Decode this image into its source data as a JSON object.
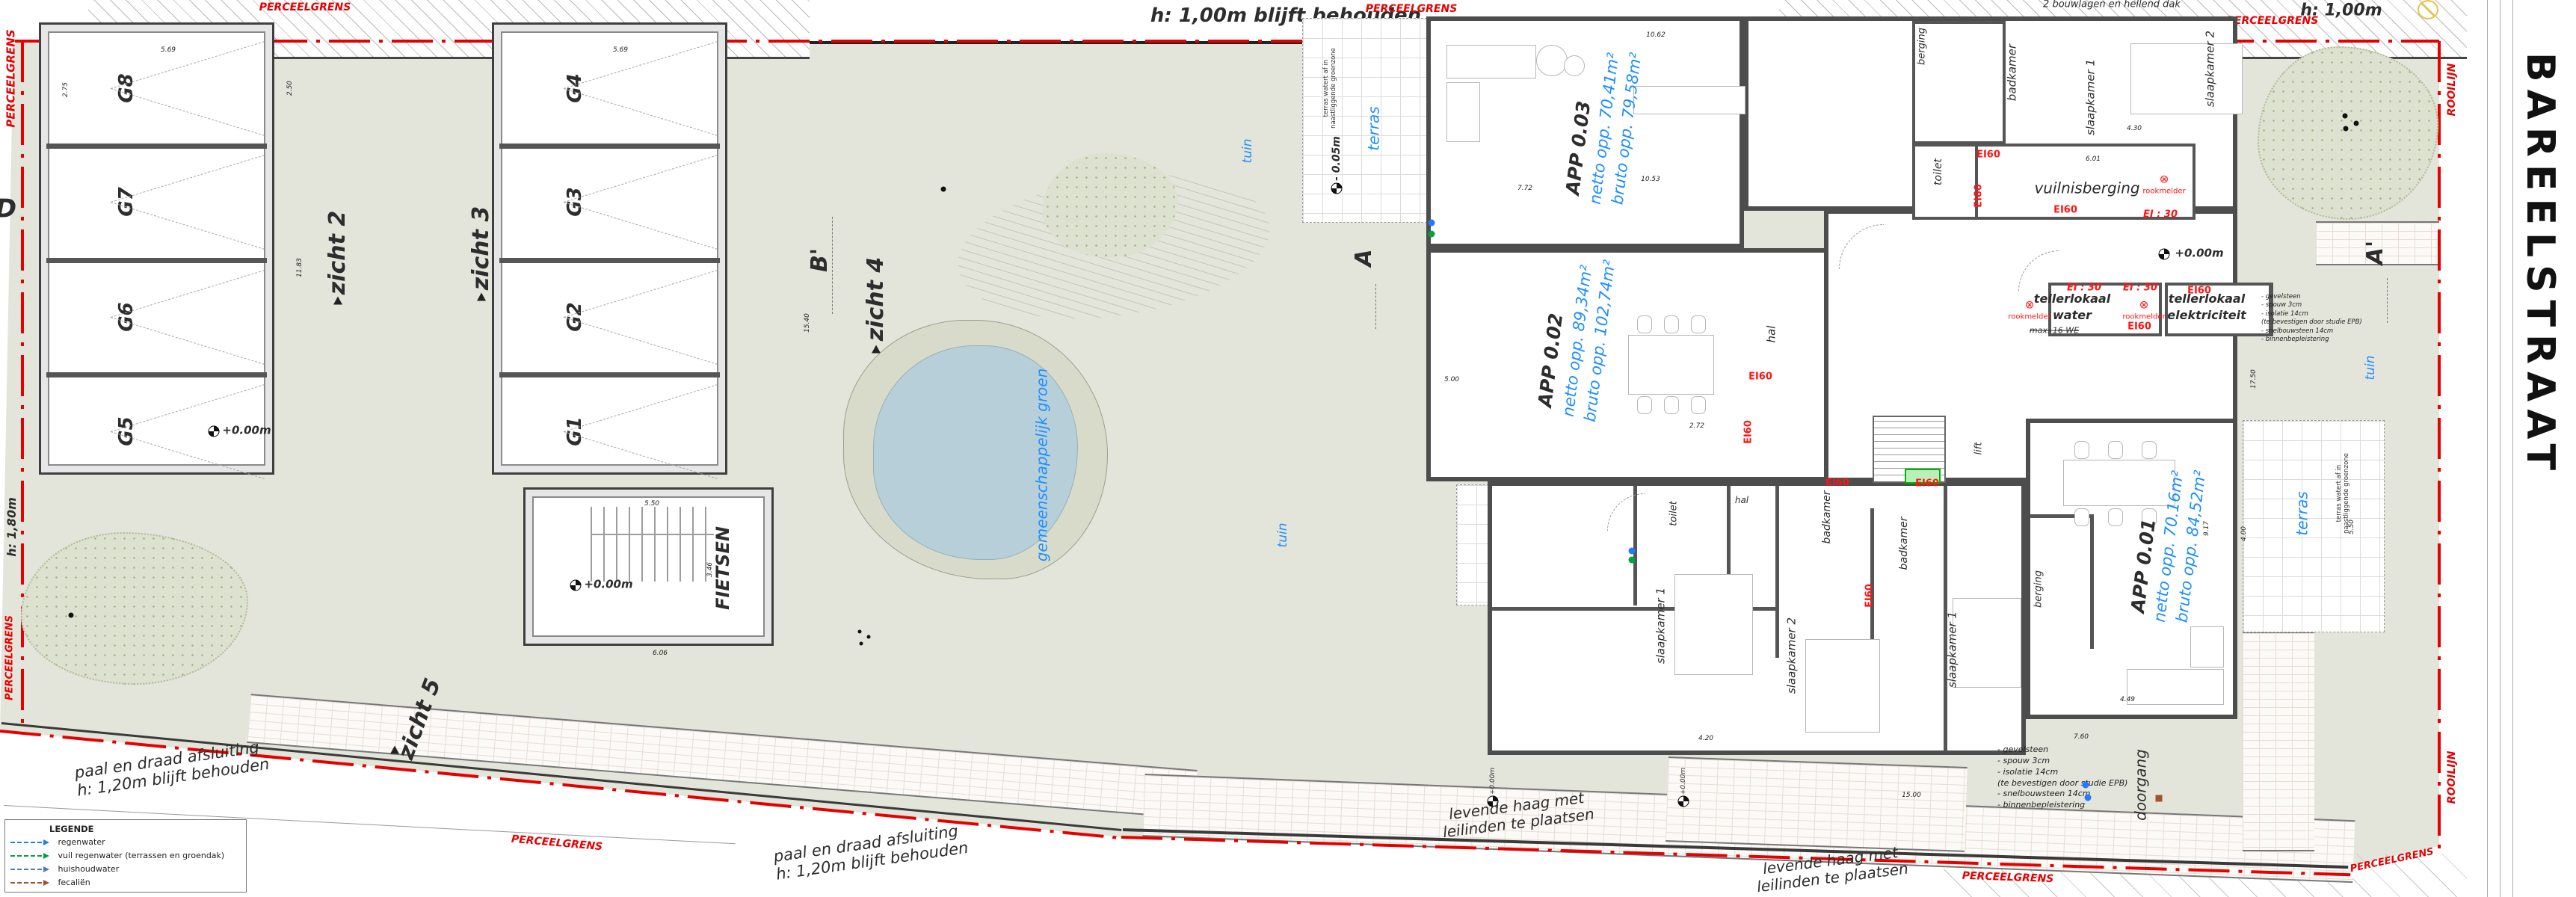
{
  "street_name": "BAREELSTRAAT",
  "boundary": {
    "perceelgrens": "PERCEELGRENS",
    "rooilijn": "ROOILIJN"
  },
  "garages": {
    "west": [
      "G8",
      "G7",
      "G6",
      "G5"
    ],
    "east": [
      "G4",
      "G3",
      "G2",
      "G1"
    ],
    "bike_room": "FIETSEN"
  },
  "views": {
    "v2": "zicht 2",
    "v3": "zicht 3",
    "v4": "zicht 4",
    "v5": "zicht 5"
  },
  "sections": {
    "d": "D",
    "b2": "B'",
    "a": "A",
    "a2": "A'"
  },
  "apartments": [
    {
      "name": "APP 0.03",
      "netto": "netto opp. 70,41m²",
      "bruto": "bruto opp. 79,58m²"
    },
    {
      "name": "APP 0.02",
      "netto": "netto opp. 89,34m²",
      "bruto": "bruto opp. 102,74m²"
    },
    {
      "name": "APP 0.01",
      "netto": "netto opp. 70.16m²",
      "bruto": "bruto opp. 84,52m²"
    }
  ],
  "rooms": {
    "berging": "berging",
    "badkamer": "badkamer",
    "slaapkamer1": "slaapkamer 1",
    "slaapkamer2": "slaapkamer 2",
    "toilet": "toilet",
    "hal": "hal",
    "lift": "lift",
    "vuilnisberging": "vuilnisberging",
    "tellerlokaal": "tellerlokaal",
    "water": "water",
    "elektriciteit": "elektriciteit",
    "max_we": "max. 16 WE",
    "doorgang": "doorgang"
  },
  "outdoor": {
    "terras": "terras",
    "tuin": "tuin",
    "groen": "gemeenschappelijk groen"
  },
  "fire": {
    "ei60": "EI60",
    "ei30": "EI : 30",
    "rookmelder": "rookmelder",
    "rm_sym": "⊗"
  },
  "levels": {
    "zero": "+0.00m",
    "minus": "- 0.05m"
  },
  "annotations": {
    "north_wall": "h: 1,00m blijft behouden",
    "ne_wall": "h: 1,00m",
    "west_fence": "h: 1,80m",
    "storeys": "2 bouwlagen en hellend dak",
    "fence1": "paal en draad afsluiting",
    "fence2": "h: 1,20m blijft behouden",
    "hedge1": "levende haag met",
    "hedge2": "leilinden te plaatsen",
    "terras_drain1": "terras watert af in",
    "terras_drain2": "naastliggende groenzone",
    "wall_note": [
      "- gevelsteen",
      "- spouw 3cm",
      "- isolatie 14cm",
      "(te bevestigen door studie EPB)",
      "- snelbouwsteen 14cm",
      "- binnenbepleistering"
    ]
  },
  "legend": {
    "title": "LEGENDE",
    "items": [
      {
        "label": "regenwater",
        "color": "#1f7bff"
      },
      {
        "label": "vuil regenwater (terrassen en groendak)",
        "color": "#00a33d"
      },
      {
        "label": "huishoudwater",
        "color": "#4a7fb5"
      },
      {
        "label": "fecaliën",
        "color": "#a0522d"
      }
    ]
  },
  "dims": [
    "5.69",
    "5.69",
    "2.75",
    "2.50",
    "11.83",
    "5.50",
    "3.46",
    "6.06",
    "15.40",
    "10.62",
    "10.53",
    "7.72",
    "5.00",
    "2.72",
    "4.30",
    "6.01",
    "15.00",
    "17.50",
    "4.00",
    "5.50",
    "9.17",
    "4.20",
    "4.49",
    "7.60"
  ],
  "colors": {
    "boundary": "#e60000",
    "site": "#e3e4da",
    "pond": "#b7cfd8",
    "bank": "#d9dbca",
    "blue_text": "#1e8fff",
    "fire": "#ff1414",
    "wall": "#4d4d4d"
  }
}
